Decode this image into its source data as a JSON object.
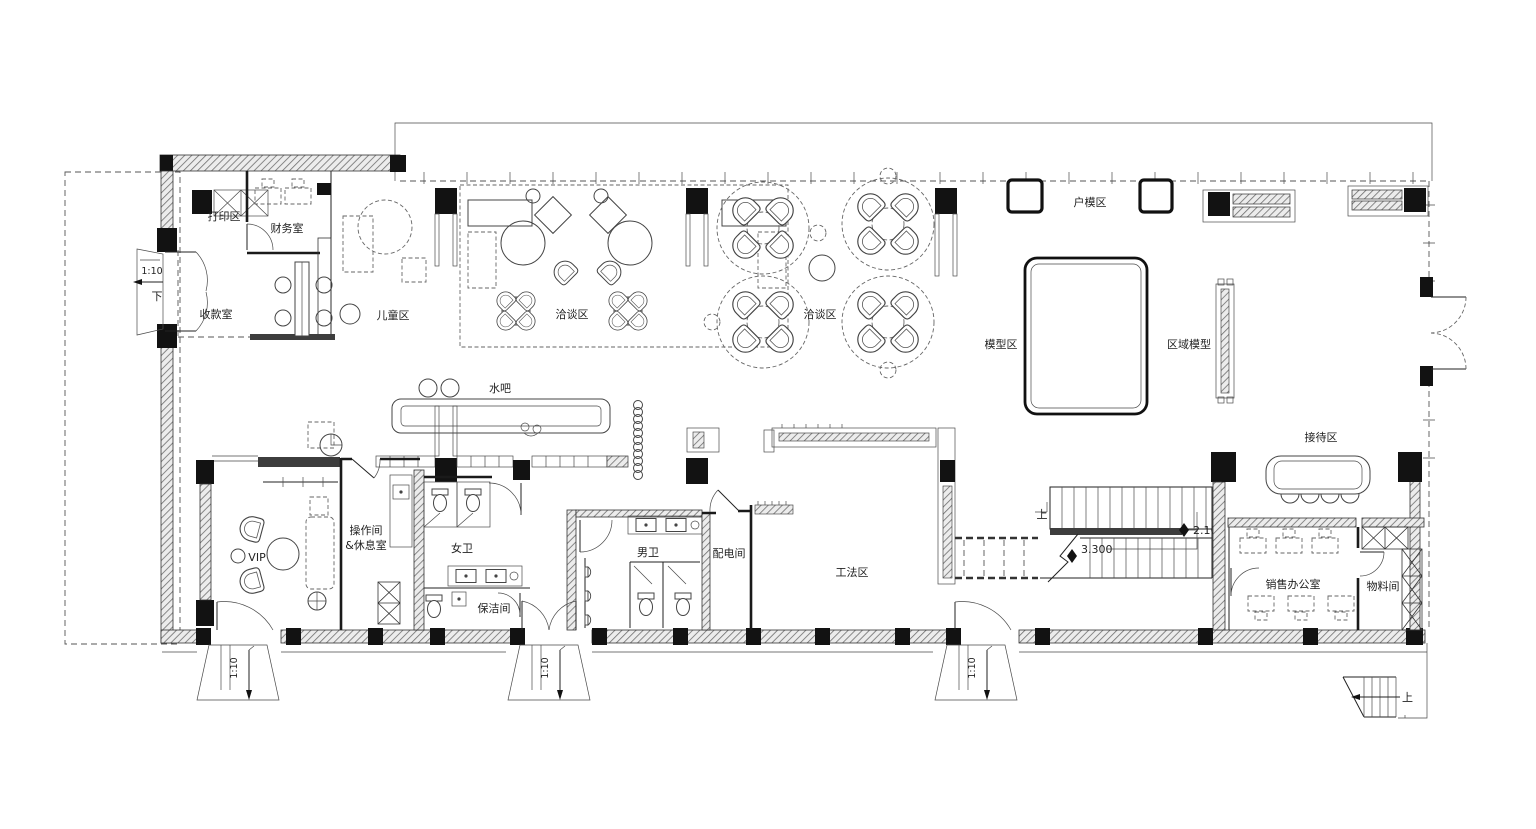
{
  "document": {
    "type": "architectural-floor-plan",
    "language": "zh-CN"
  },
  "rooms": {
    "print_area": {
      "label": "打印区"
    },
    "finance_room": {
      "label": "财务室"
    },
    "cashier_room": {
      "label": "收款室"
    },
    "kids_area": {
      "label": "儿童区"
    },
    "lounge_west": {
      "label": "洽谈区"
    },
    "lounge_east": {
      "label": "洽谈区"
    },
    "water_bar": {
      "label": "水吧"
    },
    "unit_model_area": {
      "label": "户模区"
    },
    "model_area": {
      "label": "模型区"
    },
    "regional_model": {
      "label": "区域模型"
    },
    "reception_area": {
      "label": "接待区"
    },
    "vip_room": {
      "label": "VIP"
    },
    "pantry_rest_room": {
      "label_line1": "操作间",
      "label_line2": "&休息室"
    },
    "womens_restroom": {
      "label": "女卫"
    },
    "cleaning_room": {
      "label": "保洁间"
    },
    "mens_restroom": {
      "label": "男卫"
    },
    "electrical_room": {
      "label": "配电间"
    },
    "construction_method_area": {
      "label": "工法区"
    },
    "sales_office": {
      "label": "销售办公室"
    },
    "material_room": {
      "label": "物料间"
    }
  },
  "annotations": {
    "ramp_slope": "1:10",
    "direction_down": "下",
    "direction_up": "上",
    "elevation_landing_high": "3.300",
    "elevation_landing_mid": "2.100"
  },
  "colors": {
    "line": "#1f1f1f",
    "wall_hatch": "#6e6e6e",
    "background": "#ffffff"
  }
}
